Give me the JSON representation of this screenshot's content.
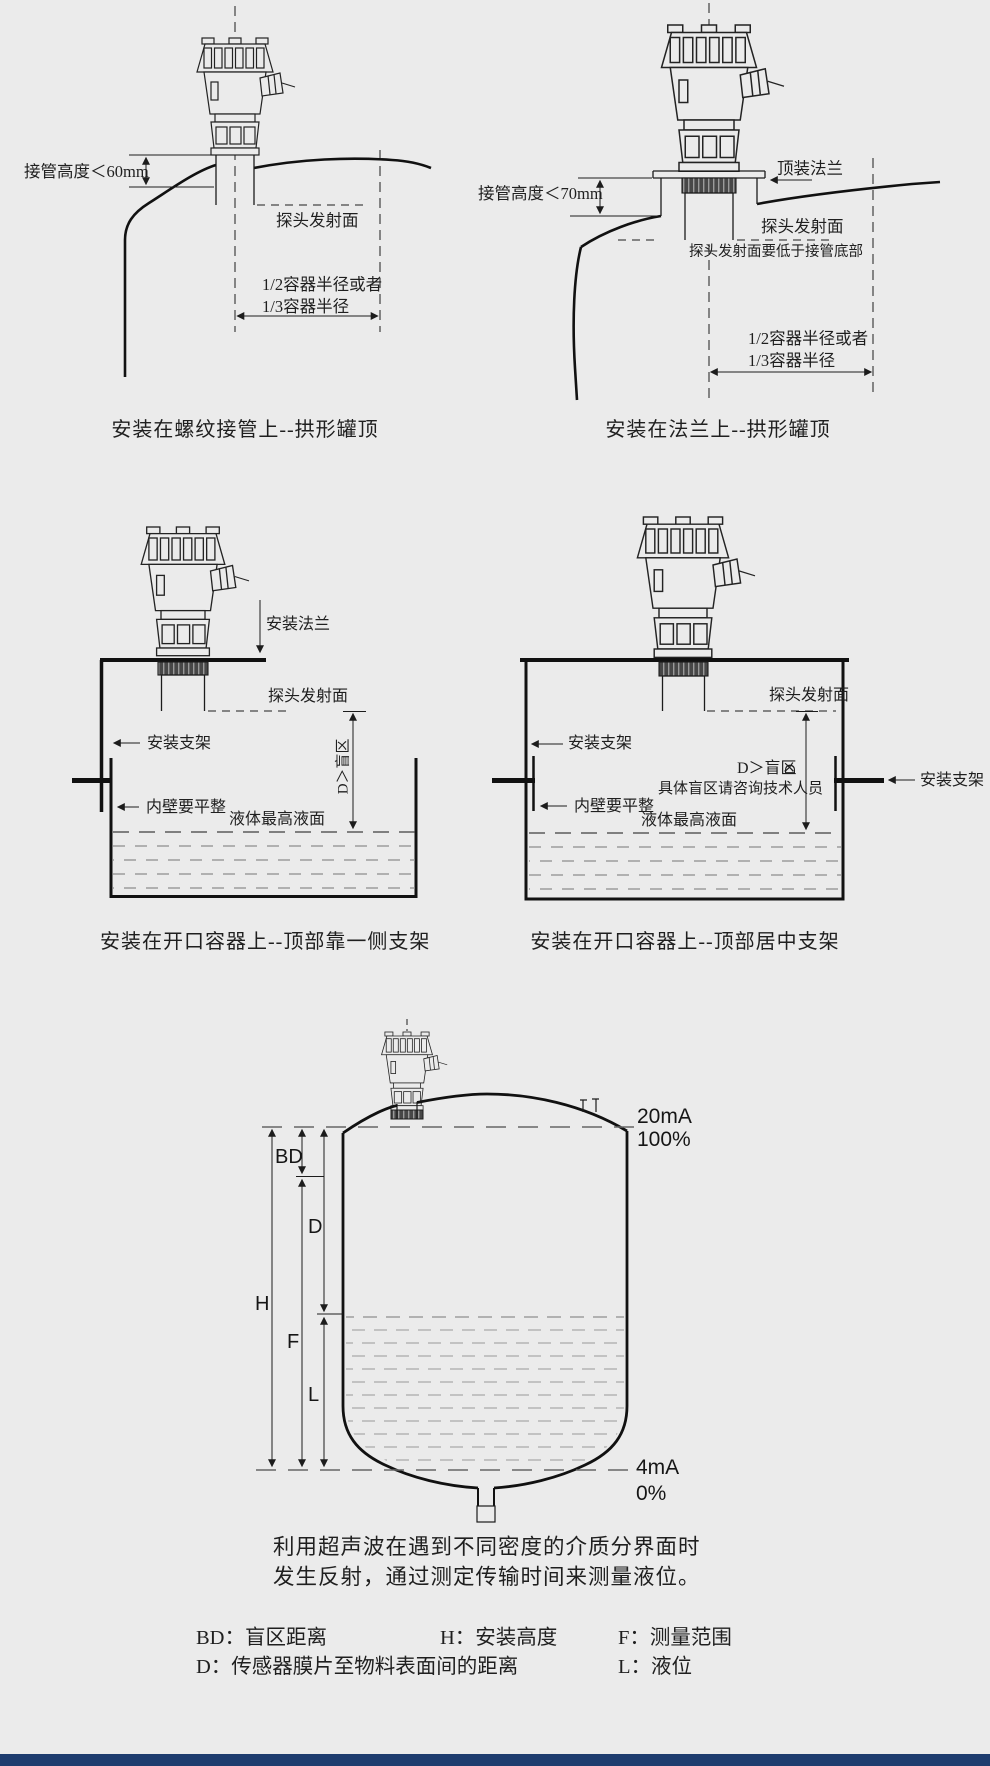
{
  "page": {
    "background": "#ebebeb",
    "footer_bar_color": "#1e3c6e"
  },
  "d1": {
    "caption": "安装在螺纹接管上--拱形罐顶",
    "pipe_height": "接管高度＜60mm",
    "emit_face": "探头发射面",
    "radius1": "1/2容器半径或者",
    "radius2": "1/3容器半径"
  },
  "d2": {
    "caption": "安装在法兰上--拱形罐顶",
    "top_flange": "顶装法兰",
    "pipe_height": "接管高度＜70mm",
    "emit_face": "探头发射面",
    "emit_note": "探头发射面要低于接管底部",
    "radius1": "1/2容器半径或者",
    "radius2": "1/3容器半径"
  },
  "d3": {
    "caption": "安装在开口容器上--顶部靠一侧支架",
    "mount_flange": "安装法兰",
    "emit_face": "探头发射面",
    "bracket": "安装支架",
    "blind_zone": "D＞盲区",
    "wall_flat": "内壁要平整",
    "max_level": "液体最高液面"
  },
  "d4": {
    "caption": "安装在开口容器上--顶部居中支架",
    "emit_face": "探头发射面",
    "bracket_left": "安装支架",
    "bracket_right": "安装支架",
    "blind_zone": "D＞盲区",
    "dim_d": "D",
    "blind_note": "具体盲区请咨询技术人员",
    "wall_flat": "内壁要平整",
    "max_level": "液体最高液面"
  },
  "d5": {
    "out_high_ma": "20mA",
    "out_high_pct": "100%",
    "out_low_ma": "4mA",
    "out_low_pct": "0%",
    "dim_bd": "BD",
    "dim_d": "D",
    "dim_h": "H",
    "dim_f": "F",
    "dim_l": "L"
  },
  "explanation": {
    "line1": "利用超声波在遇到不同密度的介质分界面时",
    "line2": "发生反射，通过测定传输时间来测量液位。"
  },
  "legend": {
    "bd": "BD：盲区距离",
    "h": "H：安装高度",
    "f": "F：测量范围",
    "d": "D：传感器膜片至物料表面间的距离",
    "l": "L：液位"
  }
}
